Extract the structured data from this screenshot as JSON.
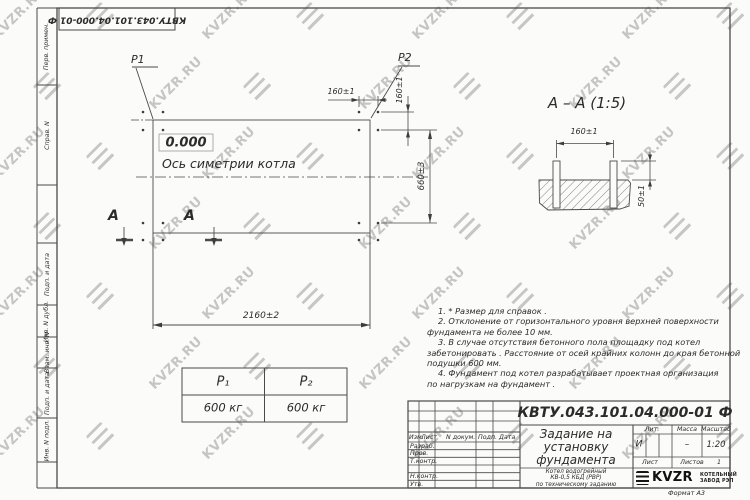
{
  "watermark": {
    "text": "KVZR.RU"
  },
  "margin_labels": {
    "perv_primen": "Перв. примен.",
    "sprav_n": "Справ. N",
    "podp_data_1": "Подп. и дата",
    "inv_dubl": "Инв. N дубл.",
    "vzam_inv": "Взам. инв. N",
    "podp_data_2": "Подп. и дата",
    "inv_podl": "Инв. N подл."
  },
  "corner_stamp": {
    "doc_number": "КВТУ.043.101.04.000-01 Ф"
  },
  "plan": {
    "p1_label": "P1",
    "p2_label": "P2",
    "level_mark": "0.000",
    "axis_label": "Ось симетрии котла",
    "dim_width": "2160±2",
    "dim_bolt_spacing_h": "160±1",
    "dim_bolt_spacing_v": "160±1",
    "dim_height": "660±3",
    "section_letter_left": "A",
    "section_letter_right": "A"
  },
  "section_view": {
    "title": "А – А (1:5)",
    "dim_bolt_spacing": "160±1",
    "dim_protrusion": "50±1"
  },
  "notes": {
    "lines": [
      "1.  * Размер для справок .",
      "2.  Отклонение от горизонтального уровня верхней поверхности",
      "фундамента не более  10  мм.",
      "3.  В случае отсутствия бетонного пола площадку под котел",
      "забетонировать . Расстояние от осей крайних колонн до края бетонной",
      "подушки  600  мм.",
      "4.  Фундамент под котел разрабатывает проектная организация",
      "по нагрузкам на фундамент ."
    ]
  },
  "load_table": {
    "headers": [
      "P₁",
      "P₂"
    ],
    "values": [
      "600 кг",
      "600 кг"
    ]
  },
  "title_block": {
    "doc_number": "КВТУ.043.101.04.000-01 Ф",
    "title_lines": [
      "Задание на",
      "установку",
      "фундамента"
    ],
    "subtitle_lines": [
      "Котел водогрейный",
      "КВ-0,5 КБД (РВР)",
      "по техническому заданию"
    ],
    "col_izm": "Изм.",
    "col_list": "Лист",
    "col_n_dokum": "N докум.",
    "col_podp": "Подп.",
    "col_data": "Дата",
    "row_razrab": "Разраб.",
    "row_prov": "Пров.",
    "row_t_kontr": "Т.контр.",
    "row_n_kontr": "Н.контр.",
    "row_utv": "Утв.",
    "lit_header": "Лит.",
    "massa_header": "Масса",
    "masshtab_header": "Масштаб",
    "lit_value": "И",
    "massa_value": "–",
    "masshtab_value": "1:20",
    "list_label": "Лист",
    "listov_label": "Листов",
    "listov_value": "1",
    "logo_text": "KVZR",
    "logo_caption_lines": [
      "КОТЕЛЬНЫЙ",
      "ЗАВОД РЭП"
    ],
    "format_label": "Формат А3"
  }
}
